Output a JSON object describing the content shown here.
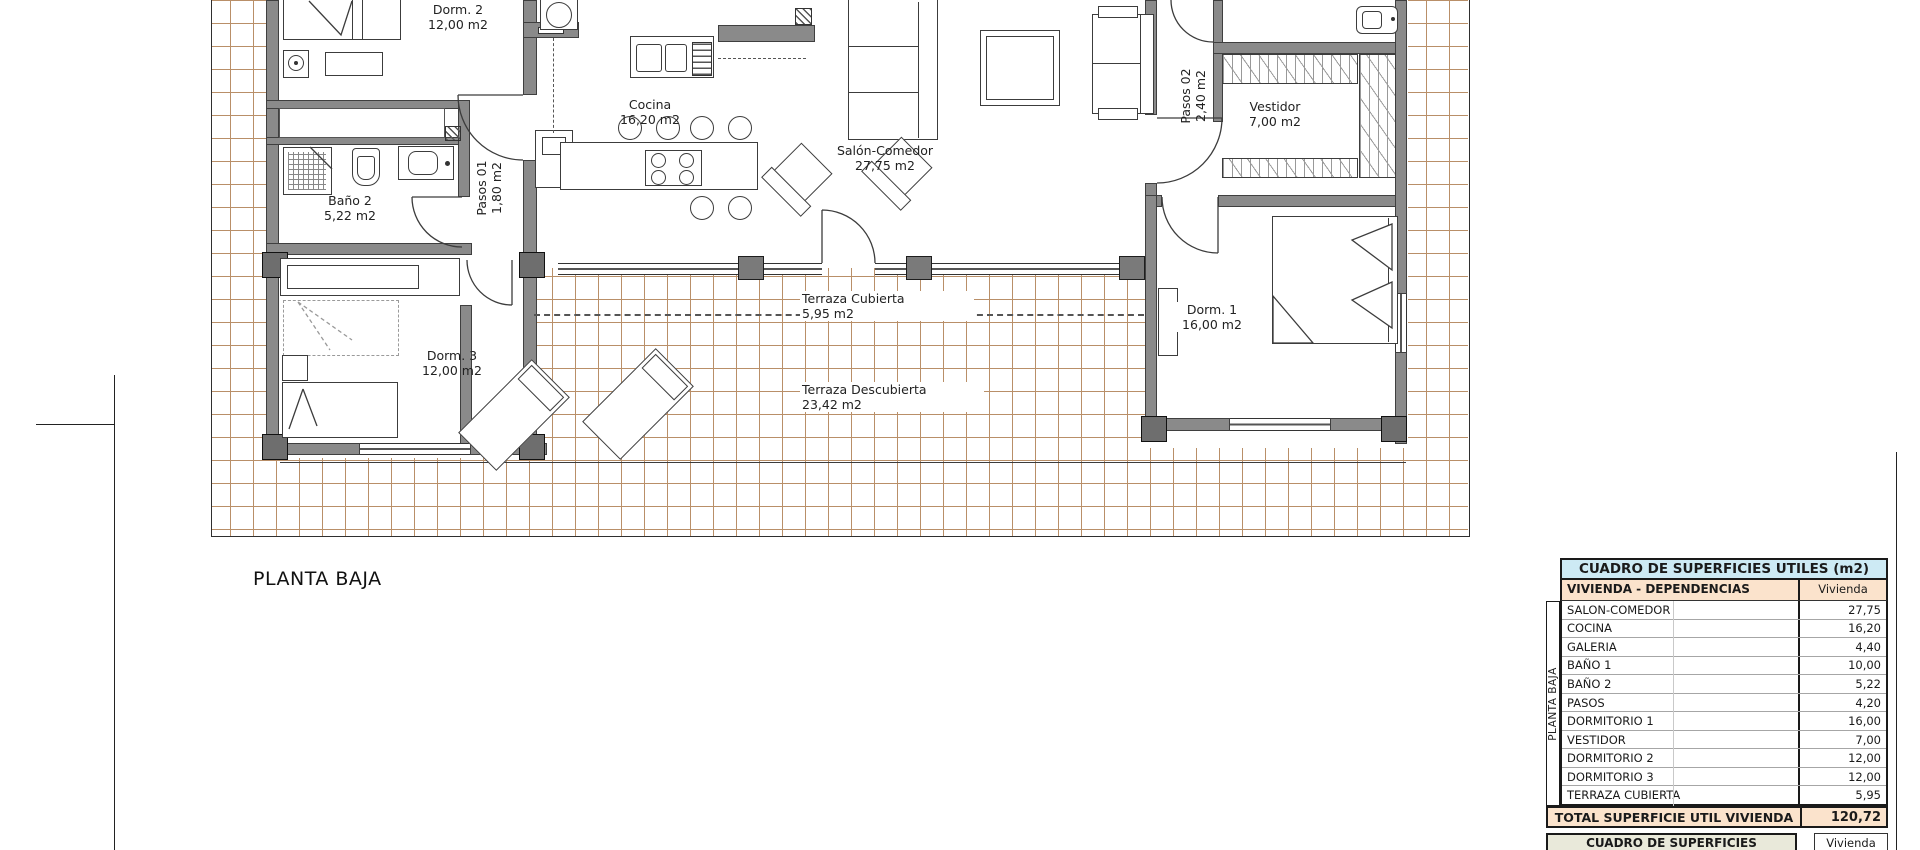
{
  "plan": {
    "title": "PLANTA BAJA",
    "rooms": [
      {
        "name": "Dorm. 2",
        "area": "12,00 m2"
      },
      {
        "name": "Cocina",
        "area": "16,20 m2"
      },
      {
        "name": "Salón-Comedor",
        "area": "27,75 m2"
      },
      {
        "name": "Pasos 02",
        "area": "2,40 m2"
      },
      {
        "name": "Vestidor",
        "area": "7,00 m2"
      },
      {
        "name": "Baño 2",
        "area": "5,22 m2"
      },
      {
        "name": "Pasos 01",
        "area": "1,80 m2"
      },
      {
        "name": "Dorm. 3",
        "area": "12,00 m2"
      },
      {
        "name": "Terraza Cubierta",
        "area": "5,95 m2"
      },
      {
        "name": "Terraza Descubierta",
        "area": "23,42 m2"
      },
      {
        "name": "Dorm. 1",
        "area": "16,00 m2"
      }
    ]
  },
  "tables": {
    "utiles": {
      "title": "CUADRO DE SUPERFICIES UTILES (m2)",
      "side_label": "PLANTA BAJA",
      "col1_header": "VIVIENDA - DEPENDENCIAS",
      "col2_header": "Vivienda",
      "rows": [
        {
          "label": "SALON-COMEDOR",
          "value": "27,75"
        },
        {
          "label": "COCINA",
          "value": "16,20"
        },
        {
          "label": "GALERIA",
          "value": "4,40"
        },
        {
          "label": "BAÑO 1",
          "value": "10,00"
        },
        {
          "label": "BAÑO 2",
          "value": "5,22"
        },
        {
          "label": "PASOS",
          "value": "4,20"
        },
        {
          "label": "DORMITORIO 1",
          "value": "16,00"
        },
        {
          "label": "VESTIDOR",
          "value": "7,00"
        },
        {
          "label": "DORMITORIO 2",
          "value": "12,00"
        },
        {
          "label": "DORMITORIO 3",
          "value": "12,00"
        },
        {
          "label": "TERRAZA CUBIERTA",
          "value": "5,95"
        }
      ],
      "total_label": "TOTAL SUPERFICIE UTIL VIVIENDA",
      "total_value": "120,72"
    },
    "construidas": {
      "title": "CUADRO DE SUPERFICIES CONSTRUIDAS (m2)",
      "col2_header": "Vivienda"
    }
  },
  "colors": {
    "table_title_bg": "#cdeaf4",
    "table_header_bg": "#fbe3cc",
    "construidas_title_bg": "#e9e9da",
    "tile_line": "#b98f68",
    "wall_gray": "#8a8a8a"
  }
}
